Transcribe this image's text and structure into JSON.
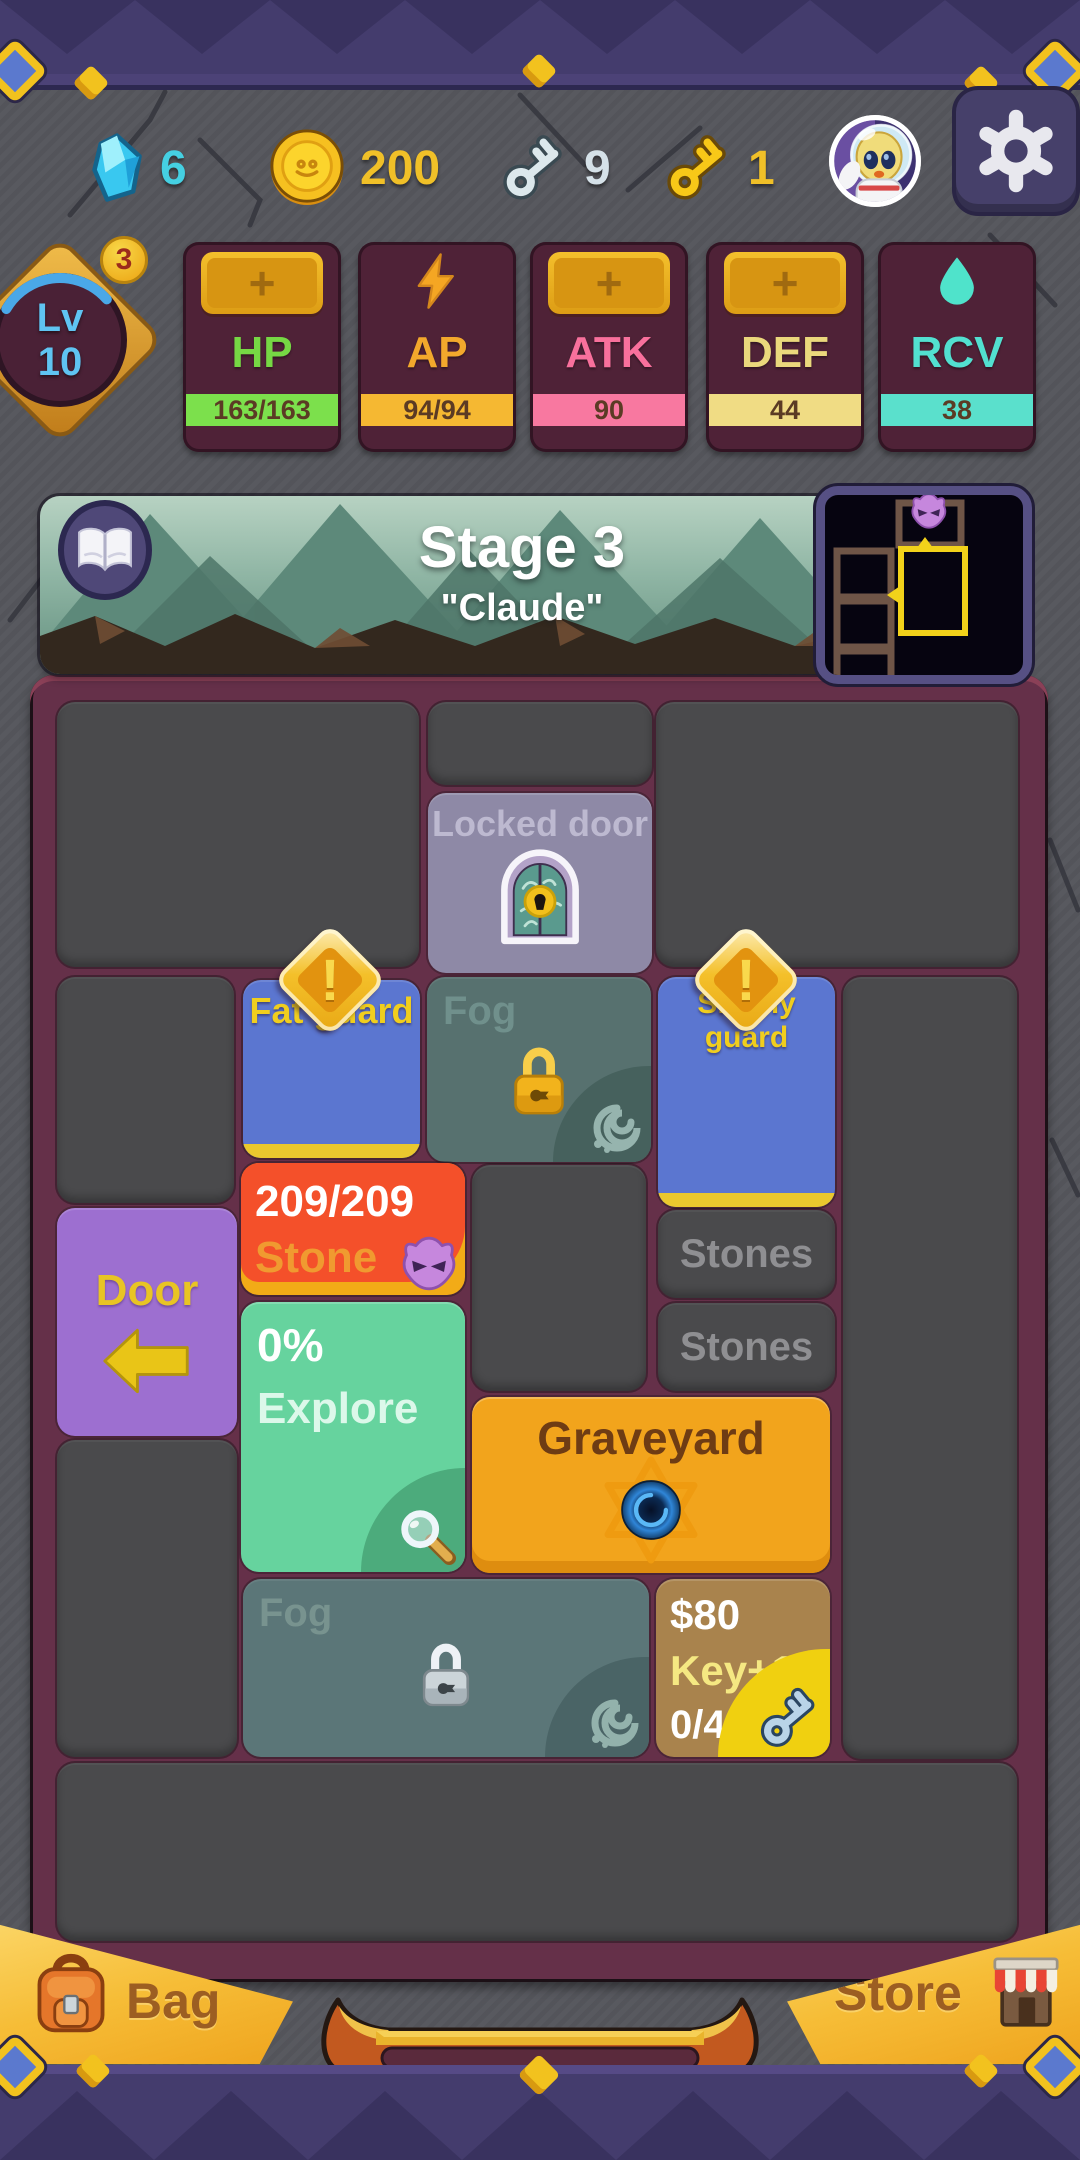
{
  "colors": {
    "stone_bg": "#55565c",
    "band_purple": "#443c6d",
    "board_frame": "#653049",
    "room_dark": "#4a4a4c",
    "room_blue": "#5b76d0",
    "room_fog": "#57716f",
    "room_locked": "#8e89a6",
    "room_stone": "#f4502a",
    "room_explore": "#66d39e",
    "room_door": "#9d6fd0",
    "room_graveyard": "#f2a41c",
    "room_key": "#a9834d",
    "accent_gold": "#f2c21e",
    "hp_green": "#7ce04c",
    "ap_orange": "#f5b832",
    "atk_pink": "#f878a0",
    "def_yellow": "#f0dc84",
    "rcv_teal": "#5ae0cc"
  },
  "header": {
    "gems": "6",
    "coins": "200",
    "silver_keys": "9",
    "gold_keys": "1"
  },
  "stats": {
    "plus": "+",
    "level": {
      "prefix": "Lv",
      "value": "10",
      "badge": "3"
    },
    "cards": [
      {
        "label": "HP",
        "value": "163/163"
      },
      {
        "label": "AP",
        "value": "94/94"
      },
      {
        "label": "ATK",
        "value": "90"
      },
      {
        "label": "DEF",
        "value": "44"
      },
      {
        "label": "RCV",
        "value": "38"
      }
    ]
  },
  "stage": {
    "title": "Stage 3",
    "subtitle": "\"Claude\""
  },
  "board": {
    "warning": "!",
    "locked_door": {
      "label": "Locked door"
    },
    "fat_guard": {
      "label": "Fat guard"
    },
    "skinny_guard": {
      "label": "Skinny guard"
    },
    "fog_upper": {
      "label": "Fog"
    },
    "fog_lower": {
      "label": "Fog"
    },
    "stone": {
      "hp": "209/209",
      "label": "Stone"
    },
    "stones_1": {
      "label": "Stones"
    },
    "stones_2": {
      "label": "Stones"
    },
    "door": {
      "label": "Door"
    },
    "explore": {
      "percent": "0%",
      "label": "Explore"
    },
    "graveyard": {
      "label": "Graveyard"
    },
    "key_room": {
      "price": "$80",
      "reward": "Key+1",
      "progress": "0/4"
    }
  },
  "footer": {
    "bag": "Bag",
    "store": "Store"
  }
}
